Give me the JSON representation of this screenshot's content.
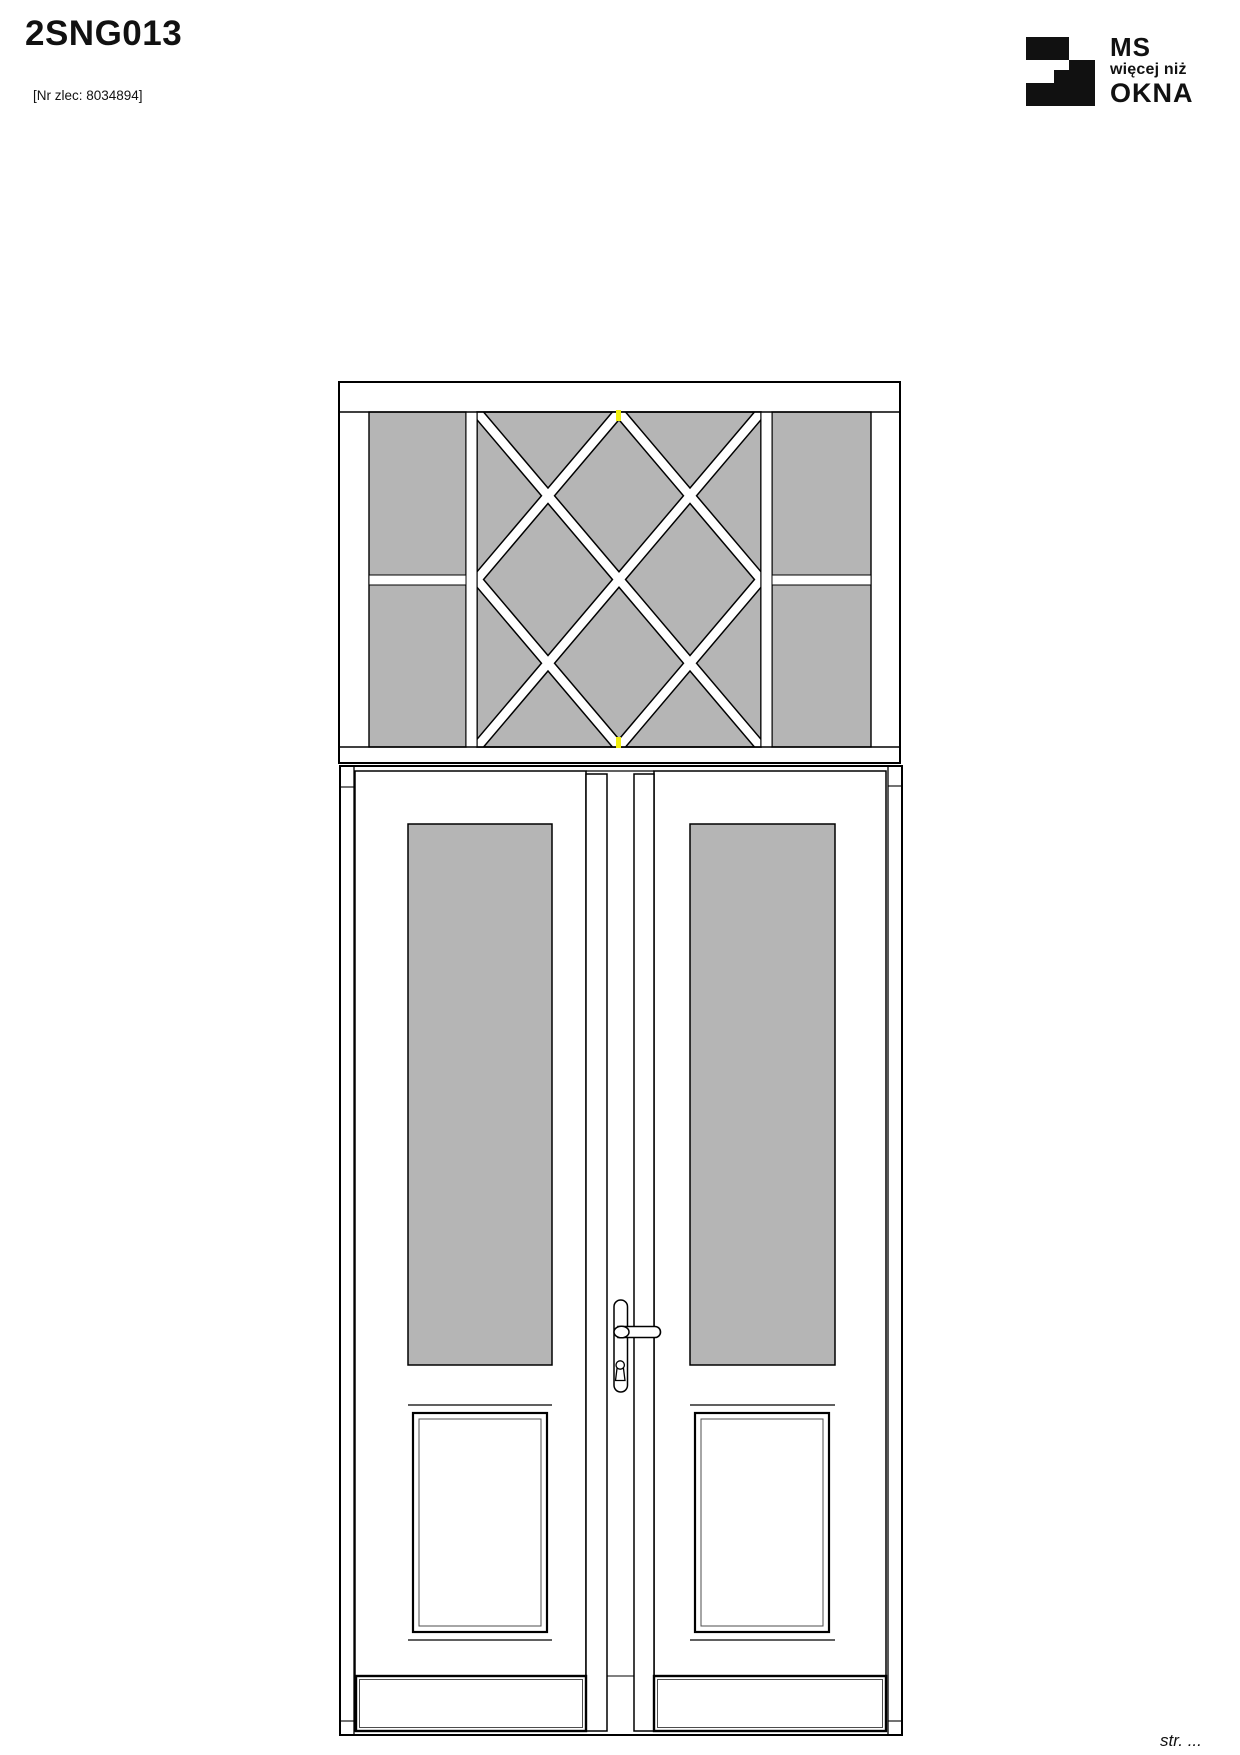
{
  "header": {
    "title": "2SNG013",
    "order_number": "[Nr zlec: 8034894]"
  },
  "logo": {
    "line1": "MS",
    "line2": "więcej niż",
    "line3": "OKNA",
    "mark": "ms-okna-block-logo"
  },
  "footer": {
    "page_label": "str. ..."
  },
  "colors": {
    "glass_fill": "#b5b5b5",
    "outline": "#000000",
    "joint_marker": "#f0ee0c",
    "logo_black": "#111111"
  }
}
